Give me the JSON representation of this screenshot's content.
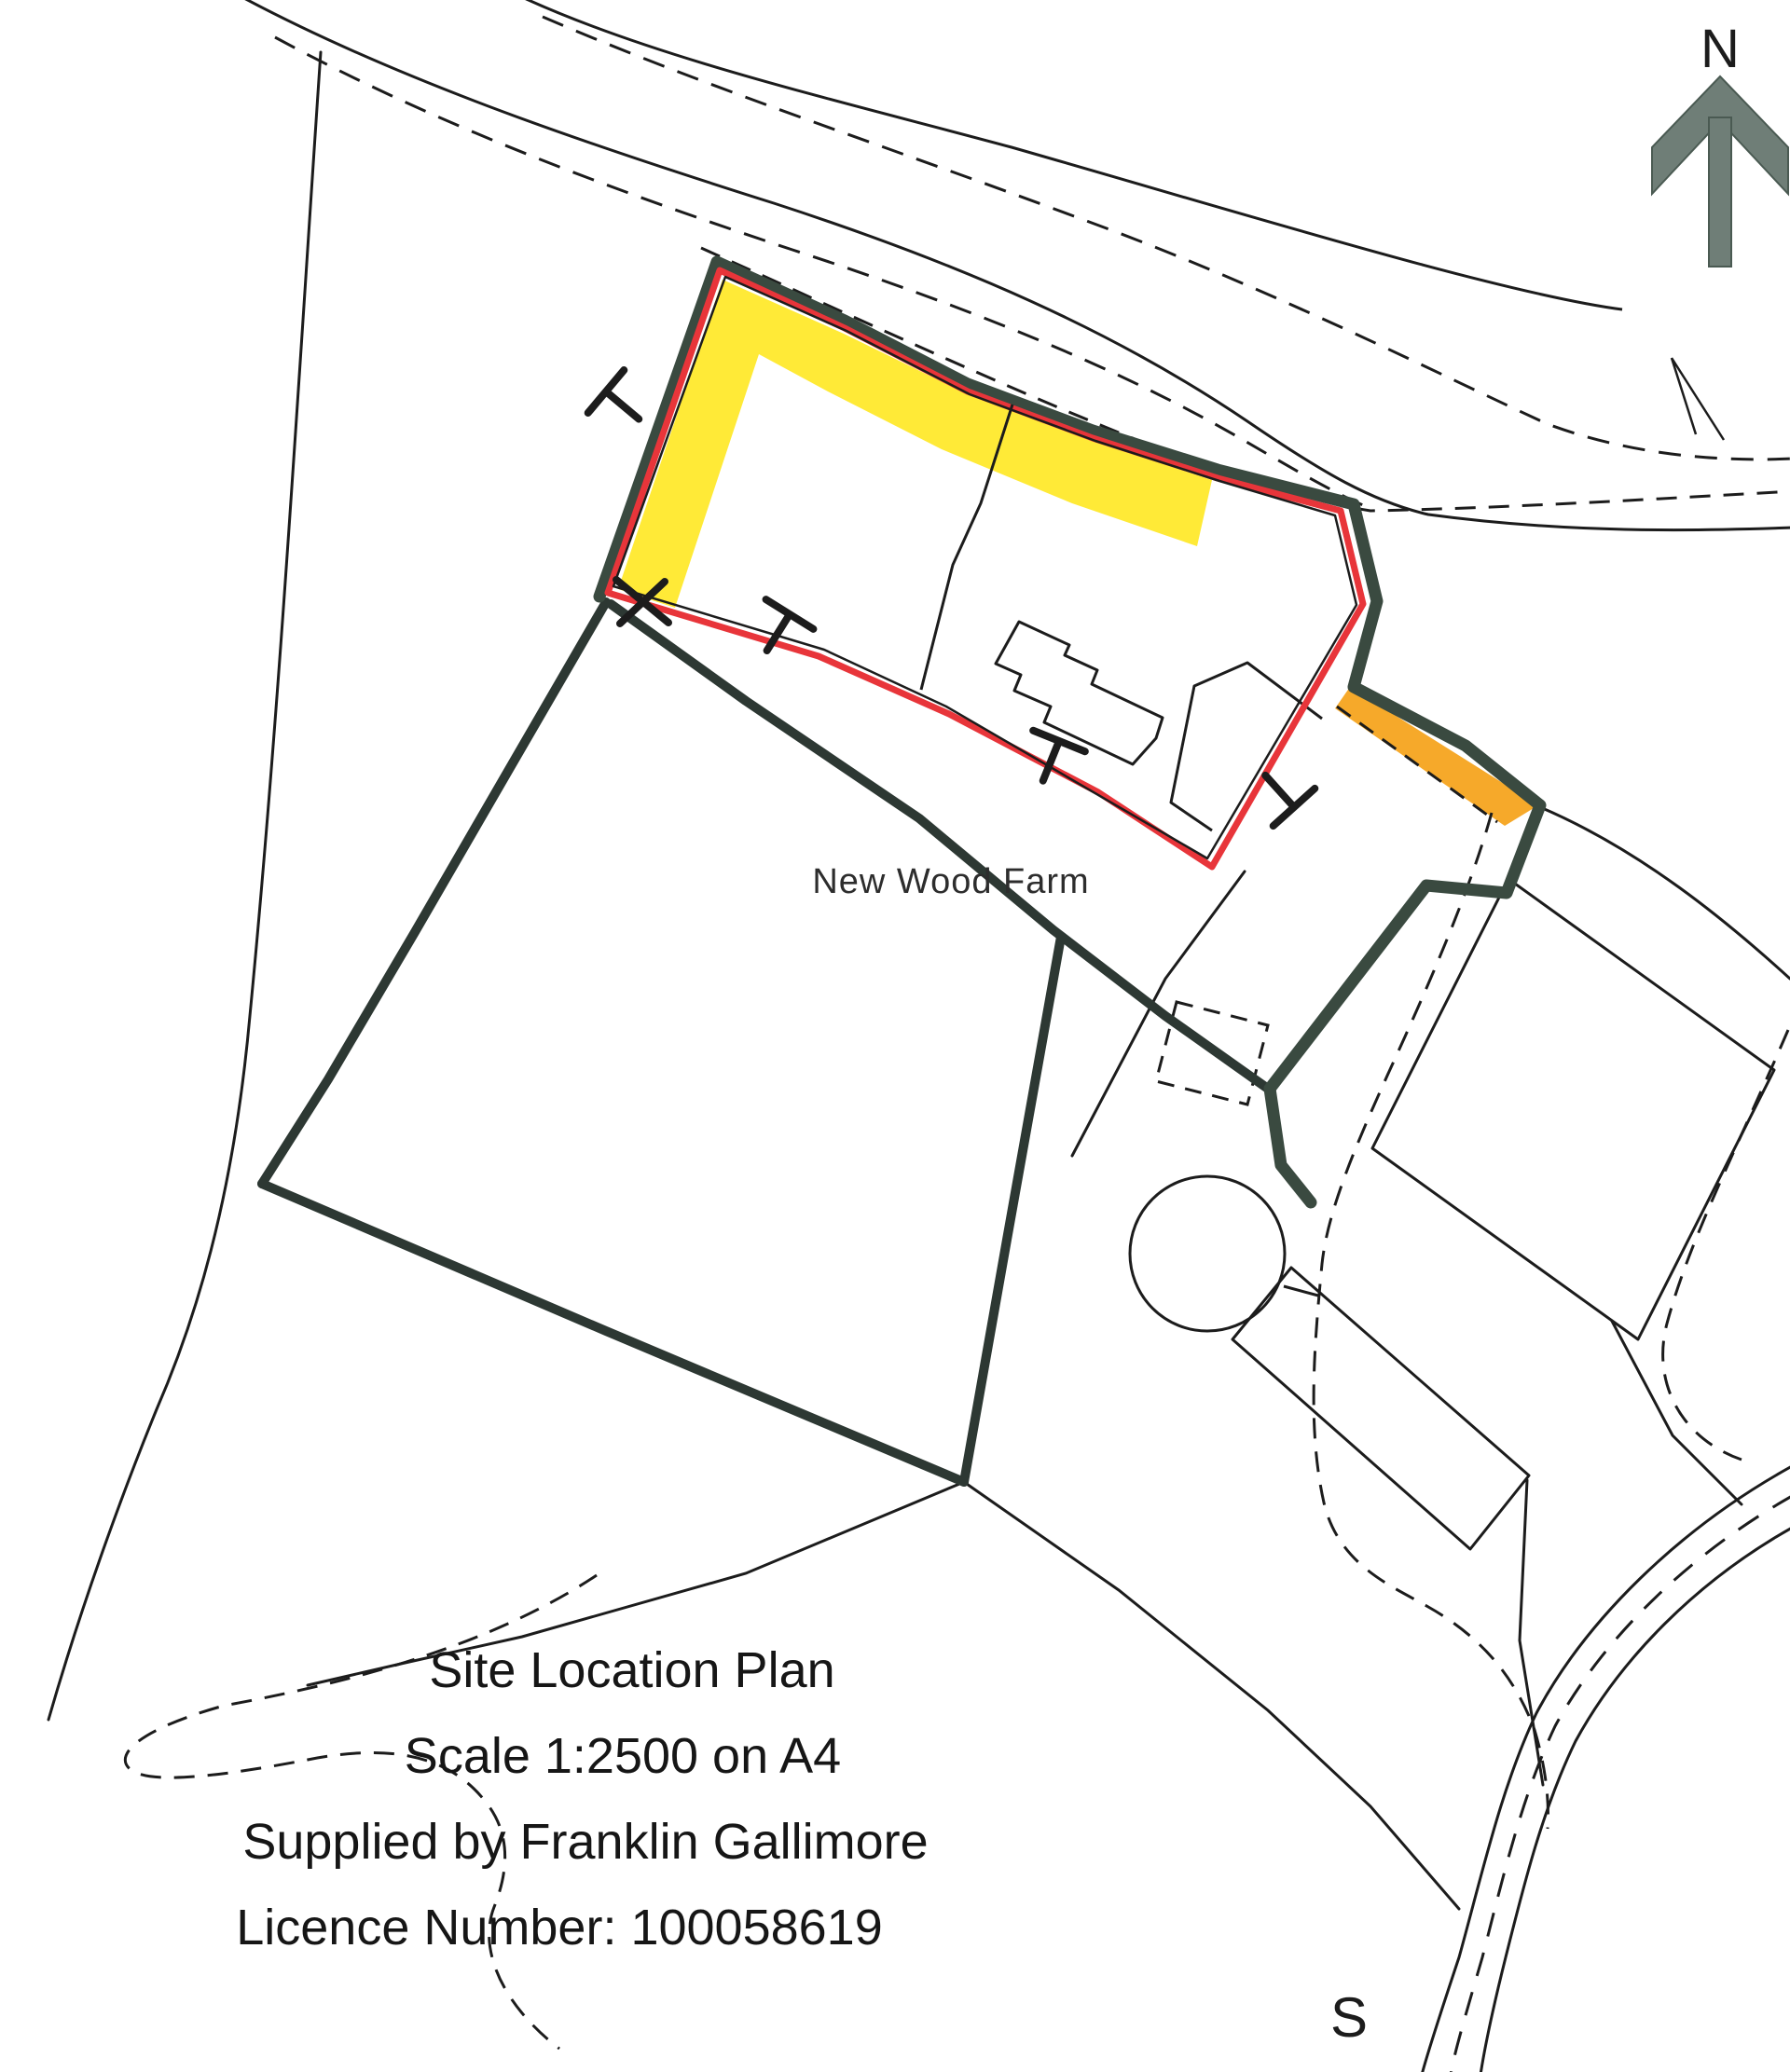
{
  "map": {
    "labels": {
      "north": "N",
      "south_road": "S",
      "farm": "New Wood Farm"
    },
    "title_block": {
      "line1": "Site Location Plan",
      "line2": "Scale 1:2500 on A4",
      "line3": "Supplied by Franklin Gallimore",
      "line4": "Licence Number: 100058619"
    },
    "colors": {
      "paper": "#ffffff",
      "line": "#1c1c1c",
      "boundary_green": "#3a4a40",
      "boundary_dark": "#2d3833",
      "site_red": "#e8353a",
      "highlight_yellow": "#ffe92c",
      "highlight_orange": "#f6a41f",
      "north_arrow_grey": "#6f7e77"
    }
  }
}
